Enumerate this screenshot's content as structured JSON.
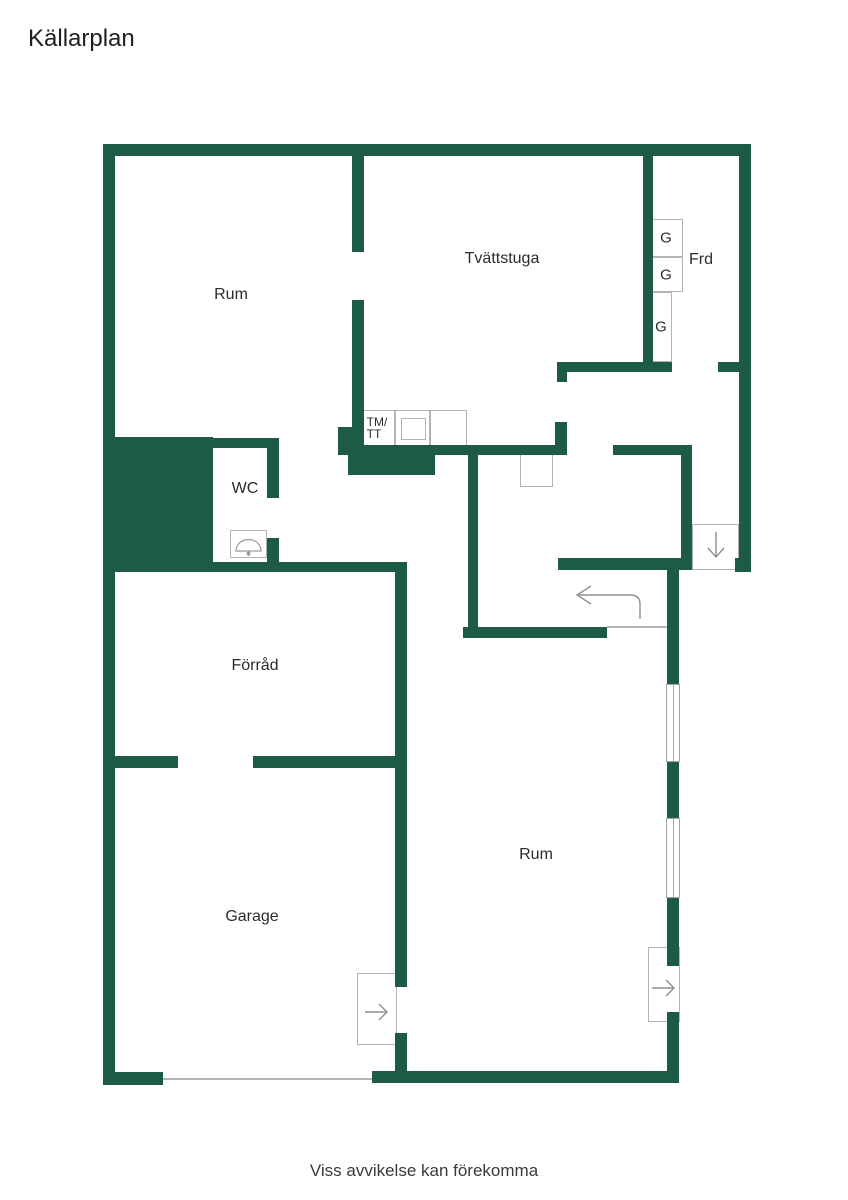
{
  "title": "Källarplan",
  "footer_disclaimer": "Viss avvikelse kan förekomma",
  "colors": {
    "wall": "#1e5b46",
    "text": "#2b2b2b",
    "line": "#b3b3b3",
    "arrow": "#8f8f8f"
  },
  "rooms": {
    "rum_upper": "Rum",
    "tvattstuga": "Tvättstuga",
    "frd": "Frd",
    "wc": "WC",
    "forrad": "Förråd",
    "garage": "Garage",
    "rum_lower": "Rum"
  },
  "fixtures": {
    "wardrobe_1": "G",
    "wardrobe_2": "G",
    "wardrobe_3": "G",
    "washer_line1": "TM/",
    "washer_line2": "TT"
  }
}
